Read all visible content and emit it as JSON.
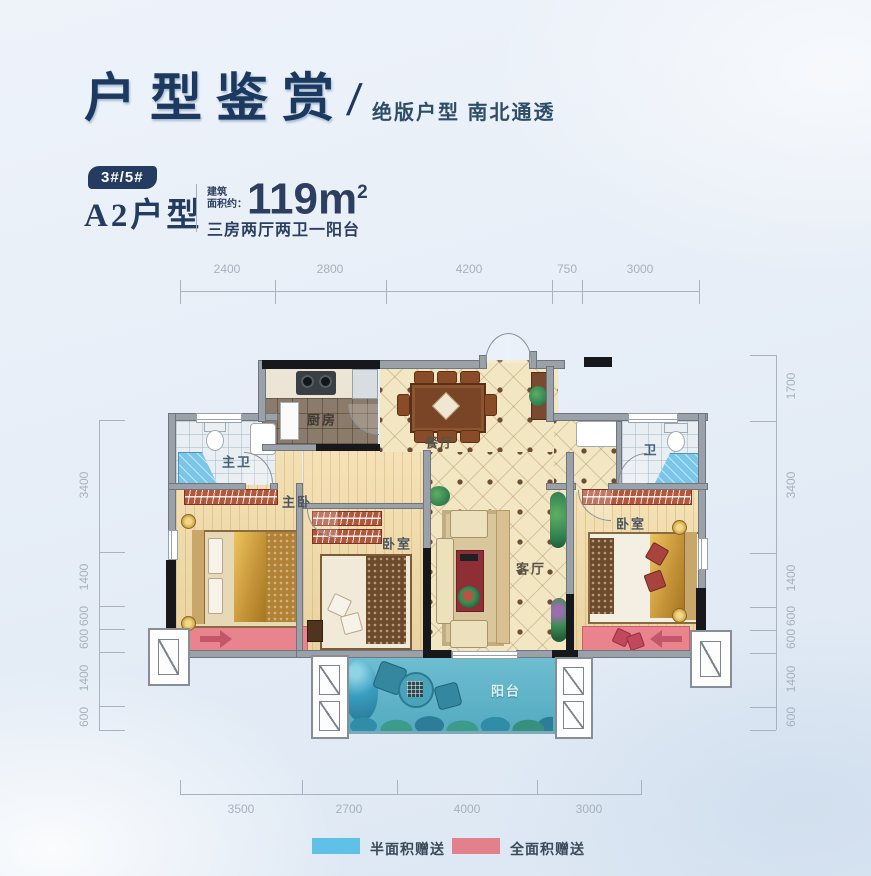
{
  "header": {
    "title": "户型鉴赏",
    "slash": "/",
    "subtitle": "绝版户型 南北通透"
  },
  "unit": {
    "badge": "3#/5#",
    "name": "A2户型",
    "area_label_line1": "建筑",
    "area_label_line2": "面积约：",
    "area_value": "119m",
    "area_sup": "2",
    "layout": "三房两厅两卫一阳台"
  },
  "rooms": {
    "master_bath": "主卫",
    "kitchen": "厨房",
    "dining": "餐厅",
    "bath": "卫",
    "master_bedroom": "主卧",
    "bedroom_mid": "卧室",
    "living": "客厅",
    "bedroom_right": "卧室",
    "balcony": "阳台"
  },
  "dimensions": {
    "top": [
      "2400",
      "2800",
      "4200",
      "750",
      "3000"
    ],
    "bottom": [
      "3500",
      "2700",
      "4000",
      "3000"
    ],
    "left": [
      "3400",
      "1400",
      "600",
      "600",
      "1400",
      "600"
    ],
    "right": [
      "1700",
      "3400",
      "1400",
      "600",
      "600",
      "1400",
      "600"
    ]
  },
  "legend": [
    {
      "label": "半面积赠送",
      "color": "#5fc0e8"
    },
    {
      "label": "全面积赠送",
      "color": "#e2808b"
    }
  ],
  "colors": {
    "accent_navy": "#243c62",
    "balcony_blue": "#5bb5cb",
    "gift_pink": "#e9848e",
    "wood_floor": "#f2dba6",
    "tile_cream": "#f3e7c3",
    "dim_text": "#a7b1bd"
  }
}
